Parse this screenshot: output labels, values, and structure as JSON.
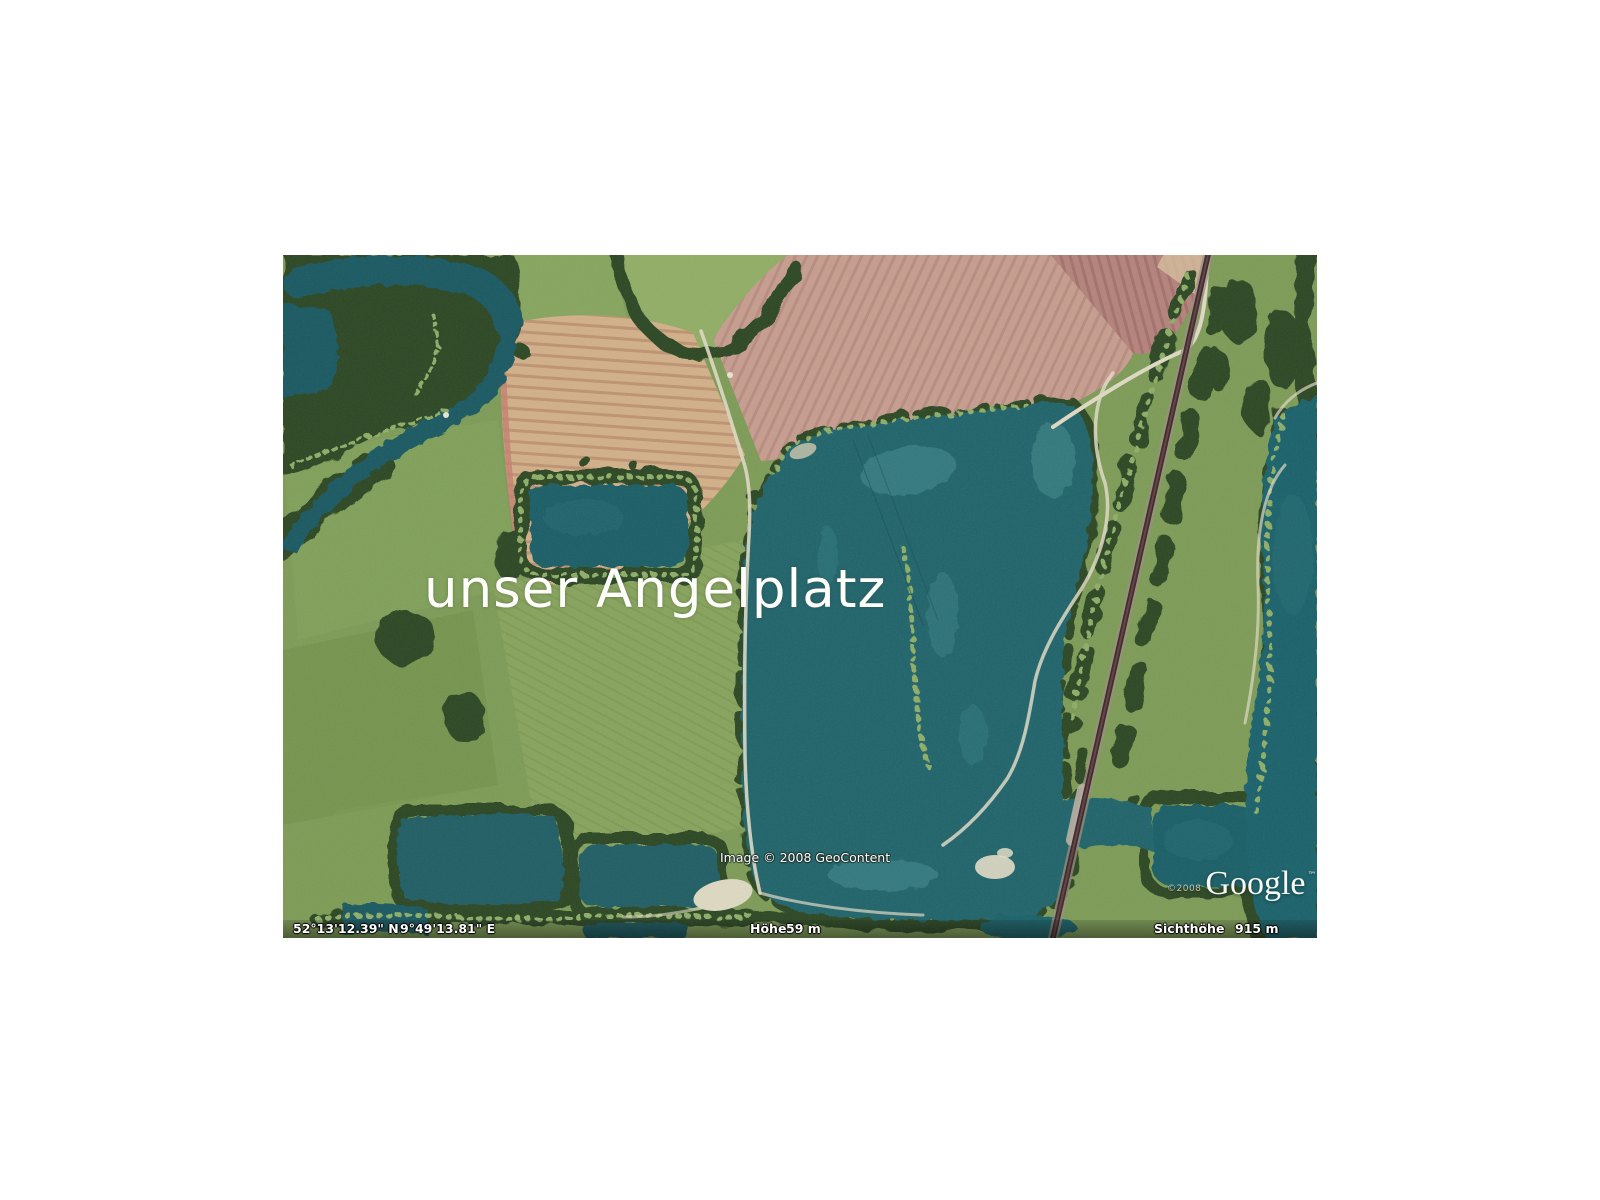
{
  "page": {
    "background": "#ffffff"
  },
  "map": {
    "title_overlay": "unser Angelplatz",
    "copyright_notice": "Image © 2008 GeoContent",
    "google_logo": {
      "year_prefix": "©2008",
      "wordmark": "Google",
      "trademark": "™"
    },
    "status_bar": {
      "latitude": "52°13'12.39\" N",
      "longitude": "9°49'13.81\" E",
      "altitude_label": "Höhe",
      "altitude_value": "59 m",
      "view_altitude_label": "Sichthöhe",
      "view_altitude_value": "915 m"
    },
    "colors": {
      "water": "#20656c",
      "deep_water": "#1b5a64",
      "shallow_water": "#4f9598",
      "meadow": "#7e9c58",
      "trees": "#2e4a27",
      "tree_highlight": "#8fae68",
      "plowed_field_tan": "#d2b08a",
      "plowed_field_pink": "#c79e90",
      "plowed_field_red": "#b5837c",
      "road": "#ded9c3",
      "railway": "#3a2a30",
      "overlay_text": "#ffffff"
    }
  }
}
